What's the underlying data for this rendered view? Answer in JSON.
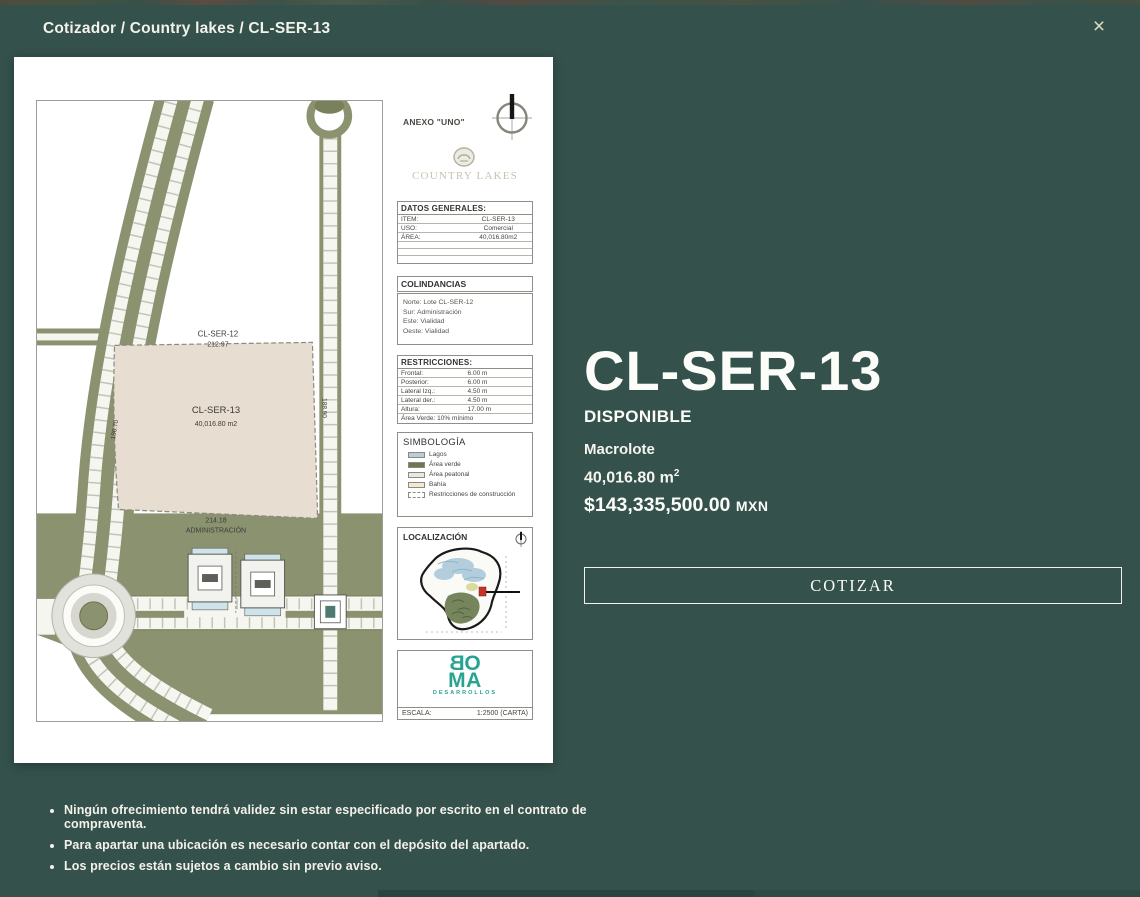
{
  "app": {
    "breadcrumb": "Cotizador / Country lakes / CL-SER-13",
    "close_glyph": "×",
    "background_color": "#34514b"
  },
  "document": {
    "annex_label": "ANEXO \"UNO\"",
    "brand": "COUNTRY LAKES",
    "datos_generales": {
      "title": "DATOS GENERALES:",
      "rows": [
        {
          "label": "ITEM:",
          "value": "CL-SER-13"
        },
        {
          "label": "USO:",
          "value": "Comercial"
        },
        {
          "label": "ÁREA:",
          "value": "40,016.80m2"
        }
      ]
    },
    "colindancias": {
      "title": "COLINDANCIAS",
      "lines": [
        "Norte: Lote CL-SER-12",
        "Sur: Administración",
        "Este: Vialidad",
        "Oeste: Vialidad"
      ]
    },
    "restricciones": {
      "title": "RESTRICCIONES:",
      "rows": [
        {
          "label": "Frontal:",
          "value": "6.00 m"
        },
        {
          "label": "Posterior:",
          "value": "6.00 m"
        },
        {
          "label": "Lateral Izq.:",
          "value": "4.50 m"
        },
        {
          "label": "Lateral der.:",
          "value": "4.50 m"
        },
        {
          "label": "Altura:",
          "value": "17.00 m"
        }
      ],
      "footer": "Área Verde: 10% mínimo"
    },
    "simbologia": {
      "title": "SIMBOLOGÍA",
      "items": [
        {
          "label": "Lagos",
          "color": "#b9cedb"
        },
        {
          "label": "Área verde",
          "color": "#6d7950"
        },
        {
          "label": "Área peatonal",
          "color": "#e8e8e2"
        },
        {
          "label": "Bahía",
          "color": "#f7e7d1"
        },
        {
          "label": "Restricciones de construcción",
          "color": "#ffffff"
        }
      ]
    },
    "localizacion": {
      "title": "LOCALIZACIÓN"
    },
    "boma": {
      "b": "B",
      "o": "O",
      "m": "M",
      "a": "A",
      "subtitle": "DESARROLLOS",
      "color": "#28a392"
    },
    "escala": {
      "label": "ESCALA:",
      "value": "1:2500 (CARTA)"
    },
    "map_labels": {
      "north_lot": "CL-SER-12",
      "north_length": "212.97",
      "plot_name": "CL-SER-13",
      "plot_area": "40,016.80 m2",
      "south_length": "214.18",
      "south_label": "ADMINISTRACIÓN",
      "west_length": "180.70",
      "east_length": "188.90"
    }
  },
  "details": {
    "title": "CL-SER-13",
    "status": "DISPONIBLE",
    "type": "Macrolote",
    "area_value": "40,016.80 m",
    "area_superscript": "2",
    "price": "$143,335,500.00",
    "currency": "MXN",
    "cta_label": "COTIZAR"
  },
  "disclaimers": [
    "Ningún ofrecimiento tendrá validez sin estar especificado por escrito en el contrato de compraventa.",
    "Para apartar una ubicación es necesario contar con el depósito del apartado.",
    "Los precios están sujetos a cambio sin previo aviso."
  ]
}
